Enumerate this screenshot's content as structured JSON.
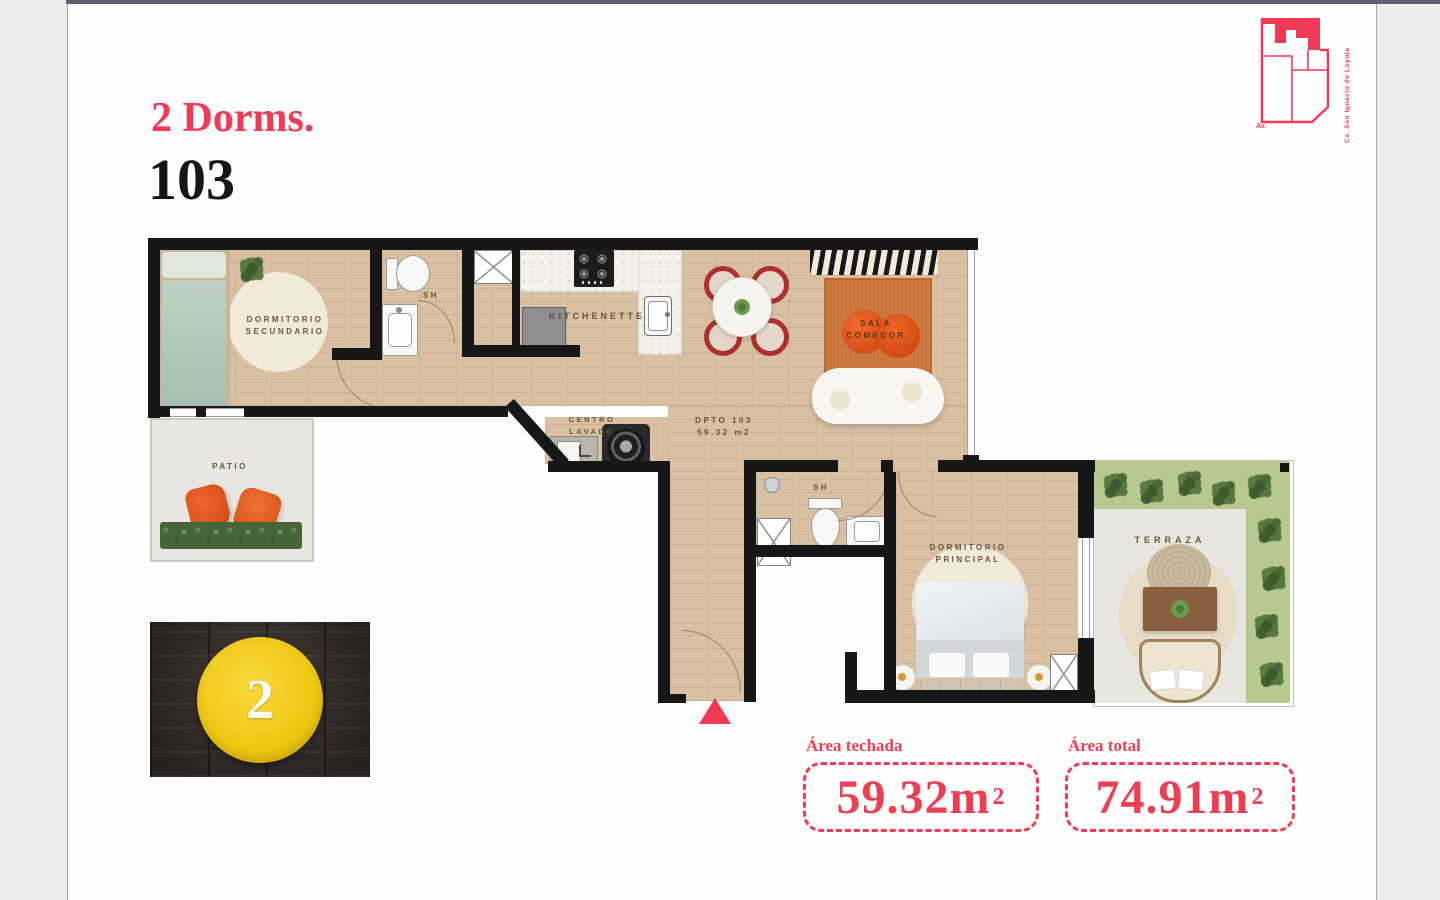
{
  "header": {
    "unit_type": "2 Dorms.",
    "unit_number": "103"
  },
  "logo": {
    "street_side": "Ca. San Ignacio de Loyola",
    "street_corner": "Av."
  },
  "floorplan": {
    "unit_label": {
      "line1": "DPTO 103",
      "line2": "59.32 m2"
    },
    "rooms": {
      "dorm_sec": {
        "line1": "DORMITORIO",
        "line2": "SECUNDARIO"
      },
      "bath1": {
        "label": "SH"
      },
      "kitchenette": {
        "label": "KITCHENETTE"
      },
      "sala": {
        "line1": "SALA",
        "line2": "COMEDOR"
      },
      "lavado": {
        "line1": "CENTRO",
        "line2": "LAVADO"
      },
      "patio": {
        "label": "PATIO"
      },
      "bath2": {
        "label": "SH"
      },
      "dorm_principal": {
        "line1": "DORMITORIO",
        "line2": "PRINCIPAL"
      },
      "terraza": {
        "label": "TERRAZA"
      }
    }
  },
  "photo_badge": {
    "number": "2"
  },
  "areas": {
    "techada": {
      "label": "Área techada",
      "value": "59.32m",
      "sup": "2"
    },
    "total": {
      "label": "Área total",
      "value": "74.91m",
      "sup": "2"
    }
  },
  "colors": {
    "accent": "#f23a57",
    "area_red": "#ee3e53",
    "wood": "#d9c0a2",
    "grass": "#b7c98f"
  }
}
